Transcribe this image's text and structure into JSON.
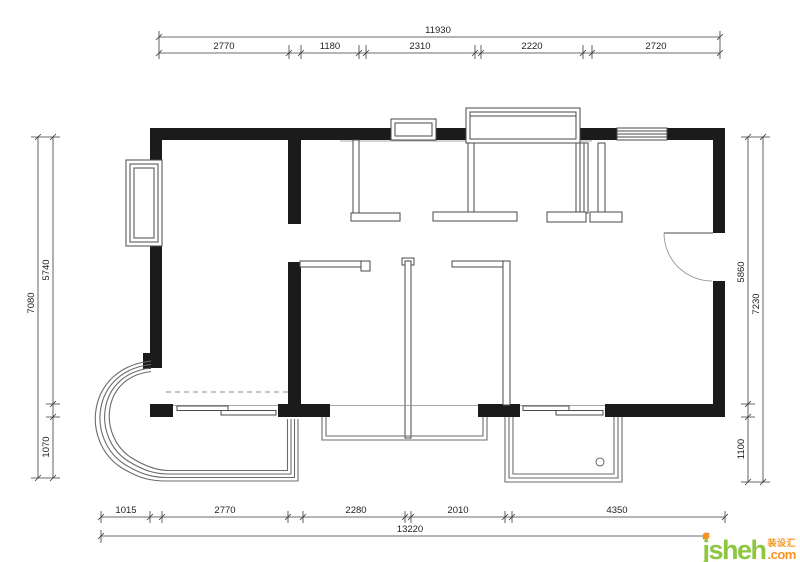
{
  "colors": {
    "wall": "#1b1b1b",
    "line": "#4a4a4a",
    "line_light": "#8a8a8a",
    "balcony": "#6b6b6b",
    "dim": "#3a3a3a",
    "dim_text": "#1f1f1f",
    "logo_green": "#8dc63f",
    "logo_orange": "#f7941d"
  },
  "dimensions": {
    "top": {
      "overall": "11930",
      "segments": [
        "2770",
        "1180",
        "2310",
        "2220",
        "2720"
      ]
    },
    "bottom": {
      "overall": "13220",
      "segments": [
        "1015",
        "2770",
        "2280",
        "2010",
        "4350"
      ]
    },
    "left": {
      "overall": "7080",
      "segments": [
        "5740",
        "1070"
      ]
    },
    "right": {
      "overall": "7230",
      "segments": [
        "5860",
        "1100"
      ]
    }
  },
  "watermark": {
    "brand": "jsheh",
    "cjk": "装设汇",
    "suffix": ".com"
  }
}
